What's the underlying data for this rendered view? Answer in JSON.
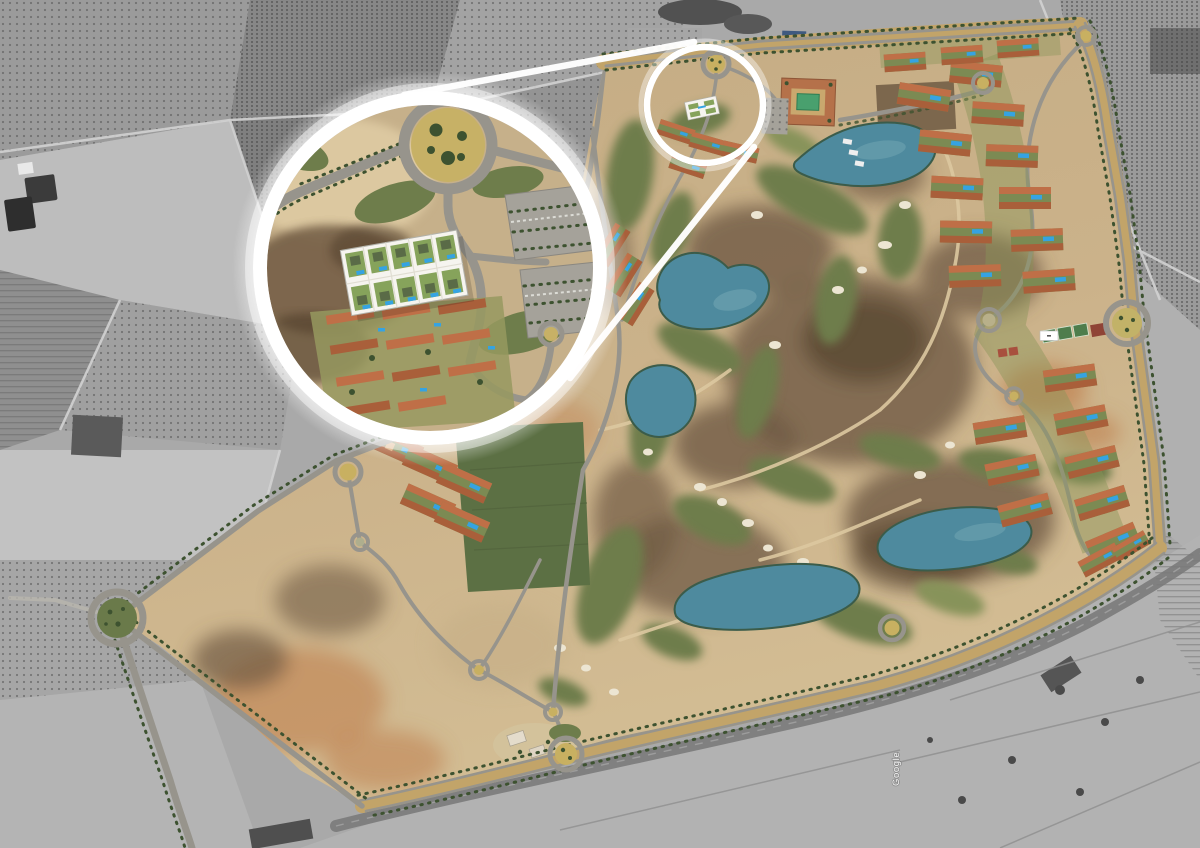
{
  "meta": {
    "type": "aerial-photomontage",
    "description": "Aerial masterplan of a golf resort community shown in colour over desaturated farmland, with a circular magnifier callout enlarging a highlighted residential parcel near the north entrance roundabout."
  },
  "watermark": {
    "text": "Google"
  },
  "callout": {
    "source": "highlighted-parcel-circle",
    "loupe": "site-detail-magnifier",
    "highlight": "white-site-plan-overlay"
  },
  "features": {
    "lakes": 5,
    "roundabouts": 12,
    "golf_course": true,
    "residential_rows": true,
    "hotel_with_courtyard_pool": true,
    "tennis_courts": true
  },
  "palette": {
    "gray_base": "#a9a9a9",
    "gray_dark": "#6f6f6f",
    "gray_mid": "#909090",
    "gray_light": "#c6c6c6",
    "sand": "#c9b189",
    "sand_light": "#dcc8a0",
    "scrub": "#6f5a43",
    "scrub_dark": "#55432f",
    "dirt": "#c08050",
    "fairway": "#6e7d4b",
    "fairway_light": "#87935a",
    "grass": "#5c7044",
    "yard": "#7c8a53",
    "lake": "#4e8a9e",
    "lake_light": "#74a7b4",
    "shore": "#3b5c4a",
    "road": "#97948c",
    "road_light": "#b9b6ae",
    "boulevard": "#c2a469",
    "highway": "#7a7a7a",
    "tree": "#3d5230",
    "roof": "#bf6f47",
    "roof_dark": "#a95f3a",
    "roof_light": "#d9a874",
    "pool": "#35a3e2",
    "courtyard_pool": "#49a06e",
    "bunker": "#ece5d2",
    "white": "#ffffff",
    "court_green": "#4e7d4c",
    "court_red": "#a8503e"
  }
}
